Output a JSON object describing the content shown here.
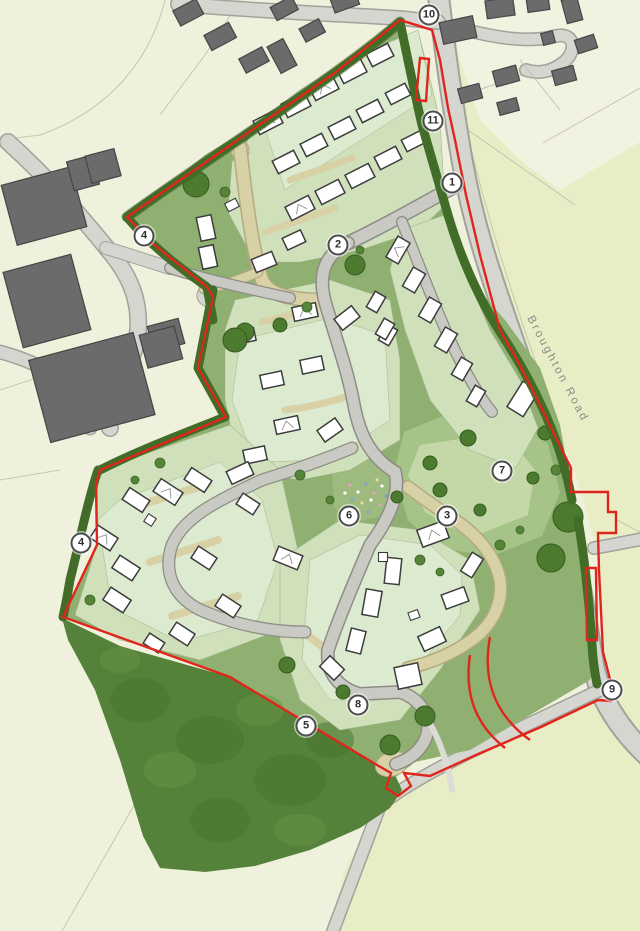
{
  "road_label": "Broughton Road",
  "markers": [
    {
      "label": "1"
    },
    {
      "label": "2"
    },
    {
      "label": "3"
    },
    {
      "label": "4"
    },
    {
      "label": "4"
    },
    {
      "label": "5"
    },
    {
      "label": "6"
    },
    {
      "label": "7"
    },
    {
      "label": "8"
    },
    {
      "label": "9"
    },
    {
      "label": "10"
    },
    {
      "label": "11"
    }
  ],
  "colors": {
    "boundary_red": "#e0251c",
    "existing_building_gray": "#6b6b6b",
    "site_green": "#8fb070",
    "hedge_green": "#416d28",
    "woodland_green": "#55823a",
    "open_space_green": "#a6c487",
    "garden_green": "#cfe0ba",
    "road_gray": "#d5d6d0",
    "shared_surface_beige": "#d8d1a6",
    "field_cream": "#f0f1dc",
    "field_yellow": "#e9edc6",
    "house_white": "#ffffff"
  }
}
